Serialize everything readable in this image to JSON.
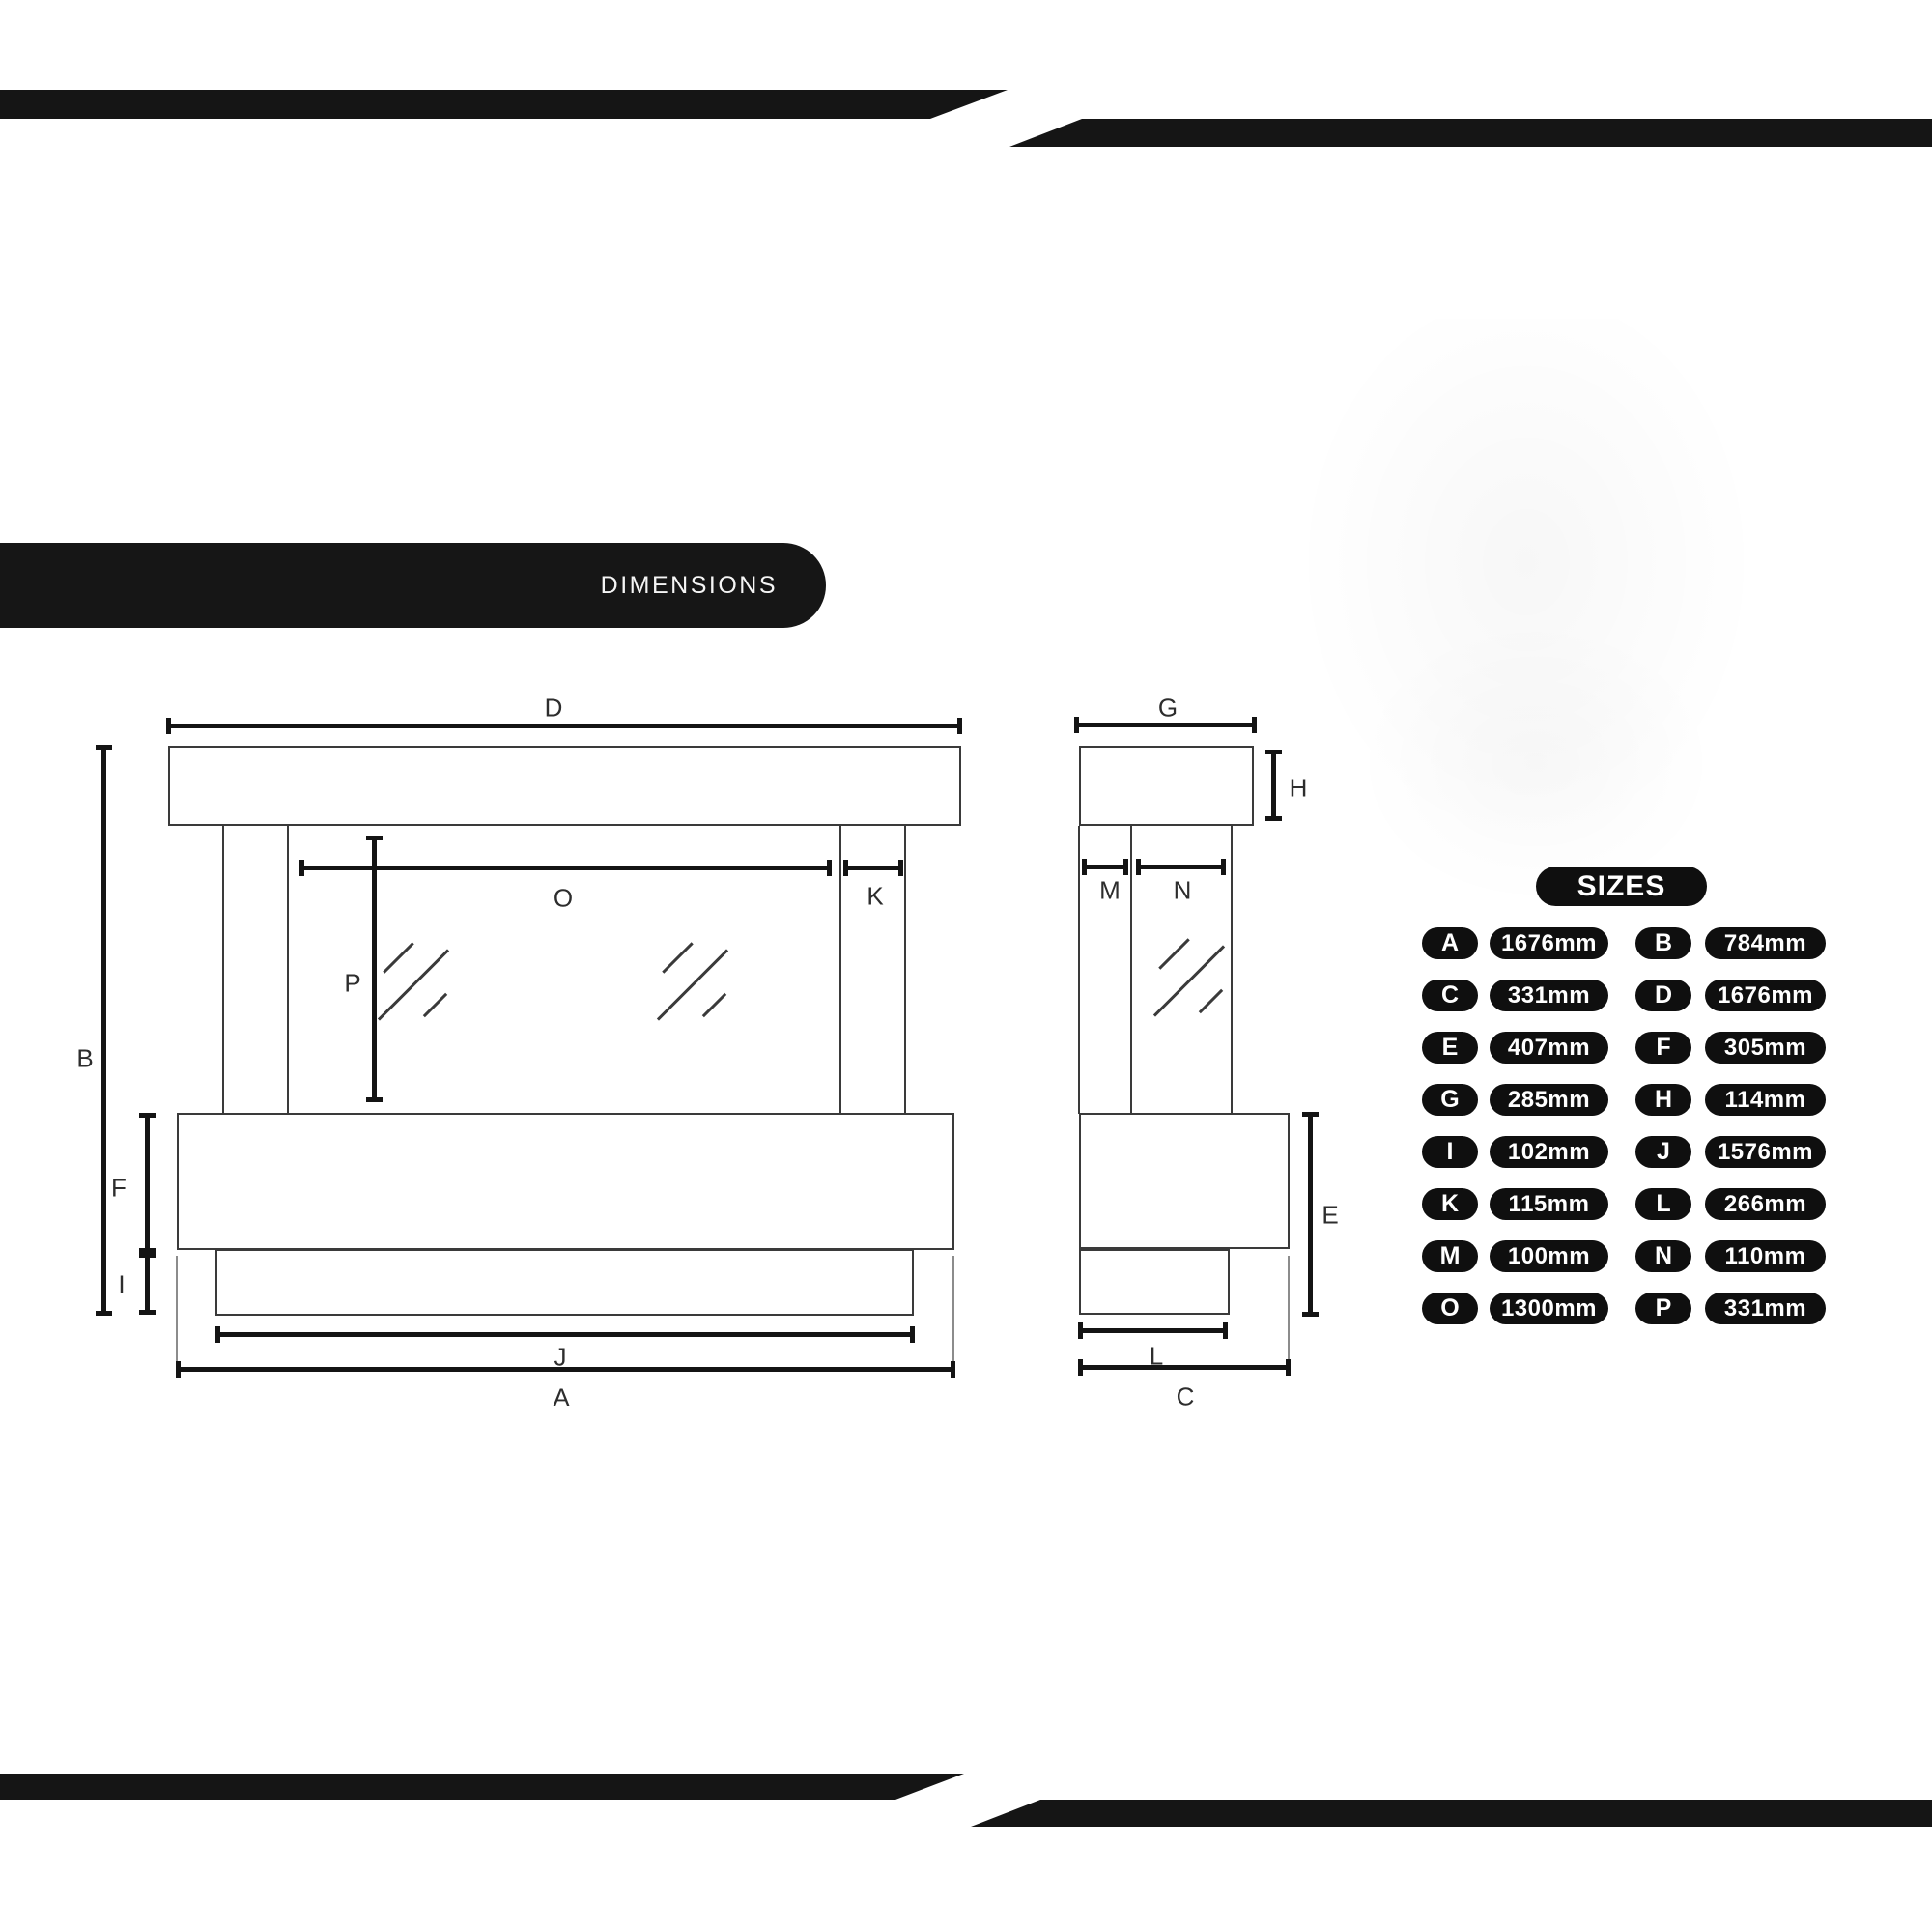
{
  "header": {
    "dimensions_label": "DIMENSIONS"
  },
  "front_view": {
    "labels": {
      "D": "D",
      "B": "B",
      "O": "O",
      "K": "K",
      "P": "P",
      "F": "F",
      "I": "I",
      "J": "J",
      "A": "A"
    }
  },
  "side_view": {
    "labels": {
      "G": "G",
      "H": "H",
      "M": "M",
      "N": "N",
      "E": "E",
      "L": "L",
      "C": "C"
    }
  },
  "sizes": {
    "title": "SIZES",
    "rows": [
      {
        "letter": "A",
        "value": "1676mm"
      },
      {
        "letter": "B",
        "value": "784mm"
      },
      {
        "letter": "C",
        "value": "331mm"
      },
      {
        "letter": "D",
        "value": "1676mm"
      },
      {
        "letter": "E",
        "value": "407mm"
      },
      {
        "letter": "F",
        "value": "305mm"
      },
      {
        "letter": "G",
        "value": "285mm"
      },
      {
        "letter": "H",
        "value": "114mm"
      },
      {
        "letter": "I",
        "value": "102mm"
      },
      {
        "letter": "J",
        "value": "1576mm"
      },
      {
        "letter": "K",
        "value": "115mm"
      },
      {
        "letter": "L",
        "value": "266mm"
      },
      {
        "letter": "M",
        "value": "100mm"
      },
      {
        "letter": "N",
        "value": "110mm"
      },
      {
        "letter": "O",
        "value": "1300mm"
      },
      {
        "letter": "P",
        "value": "331mm"
      }
    ]
  },
  "colors": {
    "banner": "#151515",
    "pill_background": "#0f0f0f",
    "pill_text": "#ffffff",
    "outline": "#3a3a3a",
    "dimension_line": "#141414",
    "background": "#ffffff"
  }
}
